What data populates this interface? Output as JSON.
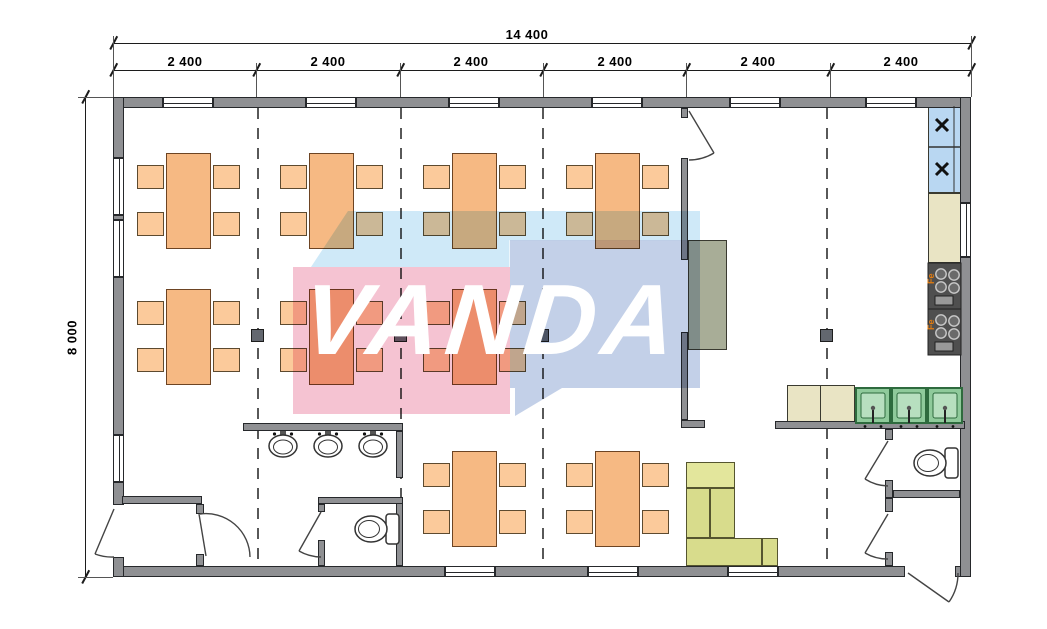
{
  "title": "Modular building floor plan — canteen layout",
  "watermark": {
    "text": "VANDA",
    "pink": "#f5c3d2",
    "blue": "#c3d0e8",
    "light_band": "#cfe9f8",
    "text_color": "#ffffff"
  },
  "dimensions": {
    "total_width": "14 400",
    "segments": [
      "2 400",
      "2 400",
      "2 400",
      "2 400",
      "2 400",
      "2 400"
    ],
    "total_height": "8 000"
  },
  "symbols": {
    "stove_label": "Fe",
    "fridge_mark": "x"
  },
  "colors": {
    "wall": "#8f9093",
    "table": "#f6b983",
    "chair": "#fbca9b",
    "sofa": "#d8dc8c",
    "sink": "#8fca9b",
    "fridge": "#b9d7f2",
    "counter": "#e9e4c4",
    "stove": "#4f4f4f",
    "cabinet": "#a8ad97"
  }
}
